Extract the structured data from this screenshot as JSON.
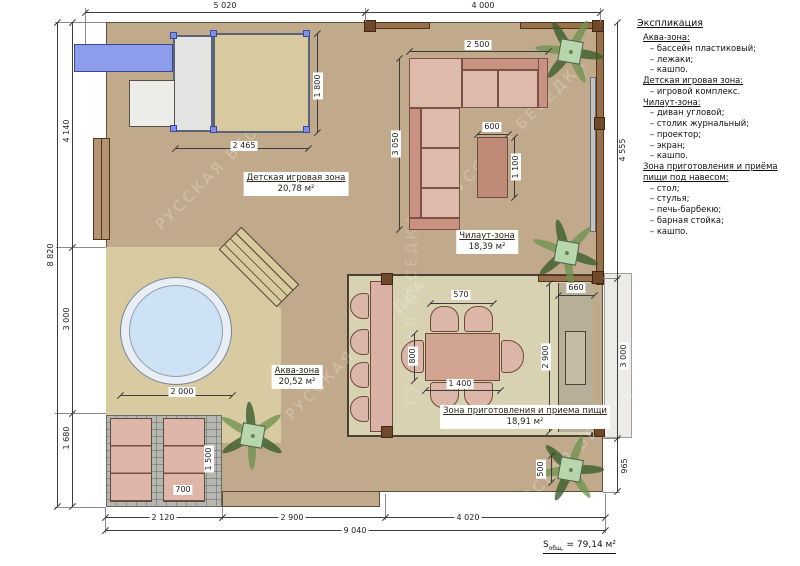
{
  "watermark": "РУССКАЯ БЕСЕДКА",
  "legend": {
    "title": "Экспликация",
    "sections": [
      {
        "header": "Аква-зона:",
        "items": [
          "– бассейн пластиковый;",
          "– лежаки;",
          "– кашпо."
        ]
      },
      {
        "header": "Детская игровая зона:",
        "items": [
          "– игровой комплекс."
        ]
      },
      {
        "header": "Чилаут-зона:",
        "items": [
          "– диван угловой;",
          "– столик журнальный;",
          "– проектор;",
          "– экран;",
          "– кашпо."
        ]
      },
      {
        "header": "Зона приготовления и приёма пищи под навесом:",
        "items": [
          "– стол;",
          "– стулья;",
          "– печь-барбекю;",
          "– барная стойка;",
          "– кашпо."
        ]
      }
    ]
  },
  "zones": {
    "play": {
      "name": "Детская игровая зона",
      "area": "20,78 м²"
    },
    "chill": {
      "name": "Чилаут-зона",
      "area": "18,39 м²"
    },
    "aqua": {
      "name": "Аква-зона",
      "area": "20,52 м²"
    },
    "dining": {
      "name": "Зона приготовления и приема пищи",
      "area": "18,91 м²"
    }
  },
  "dims": {
    "top1": "5 020",
    "top2": "4 000",
    "left_total": "8 820",
    "l1": "4 140",
    "l2": "3 000",
    "l3": "1 680",
    "r1": "4 555",
    "r2": "3 000",
    "r3": "965",
    "b1": "2 120",
    "b2": "2 900",
    "b3": "4 020",
    "b_total": "9 040",
    "play_w": "2 465",
    "play_h": "1 800",
    "sofa_w": "2 500",
    "sofa_h": "3 050",
    "ctable_w": "600",
    "ctable_l": "1 100",
    "chair_w": "570",
    "table_l": "1 400",
    "table_w": "800",
    "bbq_w": "660",
    "bbq_l": "2 900",
    "pool_d": "2 000",
    "lounger_w": "700",
    "lounger_l": "1 500",
    "plant_d": "500"
  },
  "total": {
    "prefix": "S",
    "sub": "общ.",
    "eq": " = 79,14 м²"
  },
  "colors": {
    "deck": "#c1aa8b",
    "aqua_floor": "#d8cba1",
    "dining_floor": "#d8d1b2",
    "pool_water": "#cde2f5",
    "furniture_pink": "#ddbaac",
    "slide_blue": "#8e9cec",
    "plant_green": "#3a5e2c",
    "wall_brown": "#97714e"
  }
}
